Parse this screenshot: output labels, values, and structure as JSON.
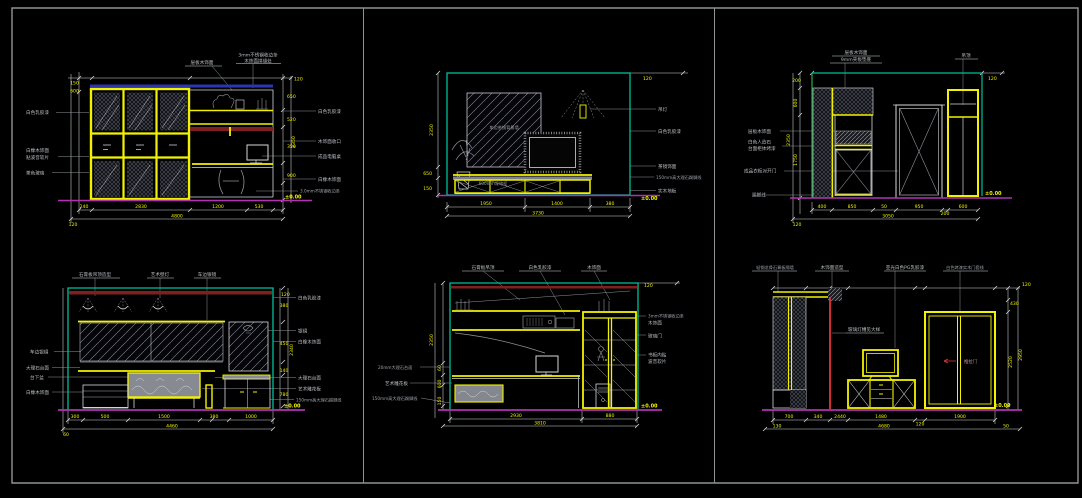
{
  "sheet": {
    "background": "#000000",
    "frame_color": "#8e9494",
    "palette": {
      "cad_yellow": "#f2f200",
      "cad_cyan": "#00c09a",
      "cad_green": "#22b14c",
      "cad_magenta": "#b232b2",
      "cad_red": "#e83434",
      "cad_maroon": "#7e2020",
      "cad_navy": "#2a36b0",
      "line_white": "#d4d7da",
      "sketch_gray": "#8f939a"
    }
  },
  "panels": [
    {
      "name": "wardrobe-desk-elevation",
      "labels": {
        "top": [
          "层板木饰面",
          "3mm不锈钢收边条",
          "木饰面拼缝处"
        ],
        "left": [
          "白色乳胶漆",
          "白橡木饰面",
          "贴波音软片",
          "茶色玻璃"
        ],
        "right": [
          "白色乳胶漆",
          "木饰面收口",
          "成品电脑桌",
          "白橡木饰面",
          "3.0mm不锈钢收边条"
        ]
      },
      "dims": {
        "left": [
          "150",
          "600"
        ],
        "right": [
          "650",
          "520",
          "350",
          "900"
        ],
        "right_total": "2350",
        "bottom": [
          "240",
          "2830",
          "1200",
          "530"
        ],
        "bottom_total": "4800",
        "bottom_left": "120",
        "top_offset": "120",
        "level": "±0.00"
      }
    },
    {
      "name": "tv-wall-elevation",
      "labels": {
        "inner": [
          "车边茶镜背景墙",
          "600mm深地柜"
        ],
        "right": [
          "吊灯",
          "白色乳胶漆",
          "茶镜饰面",
          "150mm高大理石踢脚线",
          "实木地板"
        ]
      },
      "dims": {
        "left": [
          "2350",
          "650",
          "150"
        ],
        "bottom": [
          "1950",
          "1400",
          "380"
        ],
        "bottom_total": "3730",
        "top_offset": "120",
        "level": "±0.00"
      }
    },
    {
      "name": "entry-closet-elevation",
      "labels": {
        "top": [
          "层板木饰面",
          "9mm夹板垫底",
          "吊顶"
        ],
        "left": [
          "层板木饰面",
          "白色人造石",
          "台面柜体烤漆",
          "成品衣柜对开门",
          "踢脚线"
        ]
      },
      "dims": {
        "left": [
          "200",
          "600",
          "1750"
        ],
        "left_total": "2350",
        "bottom": [
          "400",
          "850",
          "50",
          "950",
          "200",
          "600"
        ],
        "bottom_total": "3050",
        "bottom_left": "120",
        "top_offset": "120",
        "level": "±0.00"
      }
    },
    {
      "name": "vanity-elevation",
      "labels": {
        "top": [
          "石膏板吊顶造型",
          "艺术壁灯",
          "车边银镜"
        ],
        "left": [
          "车边银镜",
          "大理石台面",
          "台下盆",
          "白橡木饰面"
        ],
        "right": [
          "白色乳胶漆",
          "银镜",
          "白橡木饰面",
          "大理石台面",
          "艺术雕花板",
          "150mm高大理石踢脚线"
        ]
      },
      "dims": {
        "right": [
          "380",
          "450",
          "140",
          "780"
        ],
        "right_total": "2340",
        "bottom": [
          "300",
          "500",
          "1500",
          "380",
          "1000"
        ],
        "bottom_total": "4460",
        "bottom_left": "60",
        "top_offset": "120",
        "level": "±0.00"
      }
    },
    {
      "name": "study-desk-bookcase-elevation",
      "labels": {
        "top": [
          "石膏板吊顶",
          "白色乳胶漆",
          "木饰面"
        ],
        "left": [
          "20mm大理石台面",
          "艺术雕花板",
          "150mm高大理石踢脚线"
        ],
        "right": [
          "3mm不锈钢收边条",
          "木饰面",
          "玻璃门",
          "书柜内贴",
          "波音软片"
        ]
      },
      "dims": {
        "left": [
          "60",
          "600",
          "150"
        ],
        "left_total": "2350",
        "bottom": [
          "2930",
          "880"
        ],
        "bottom_total": "3810",
        "top_offset": "120",
        "level": "±0.00"
      }
    },
    {
      "name": "bedroom-tv-wardrobe-elevation",
      "labels": {
        "top": [
          "轻钢龙骨石膏板隔墙",
          "木饰面造型",
          "亚光白色PG乳胶漆",
          "白色烤漆实木门套线"
        ],
        "inner": [
          "玻璃灯槽见大样",
          "推拉门"
        ]
      },
      "dims": {
        "right": [
          "430",
          "2520"
        ],
        "right_total": "2950",
        "bottom": [
          "700",
          "340",
          "2440",
          "1480",
          "120",
          "1900"
        ],
        "bottom_total": "4680",
        "bottom_left": "130",
        "bottom_right": "50",
        "top_offset": "120",
        "level": "±0.00"
      }
    }
  ]
}
